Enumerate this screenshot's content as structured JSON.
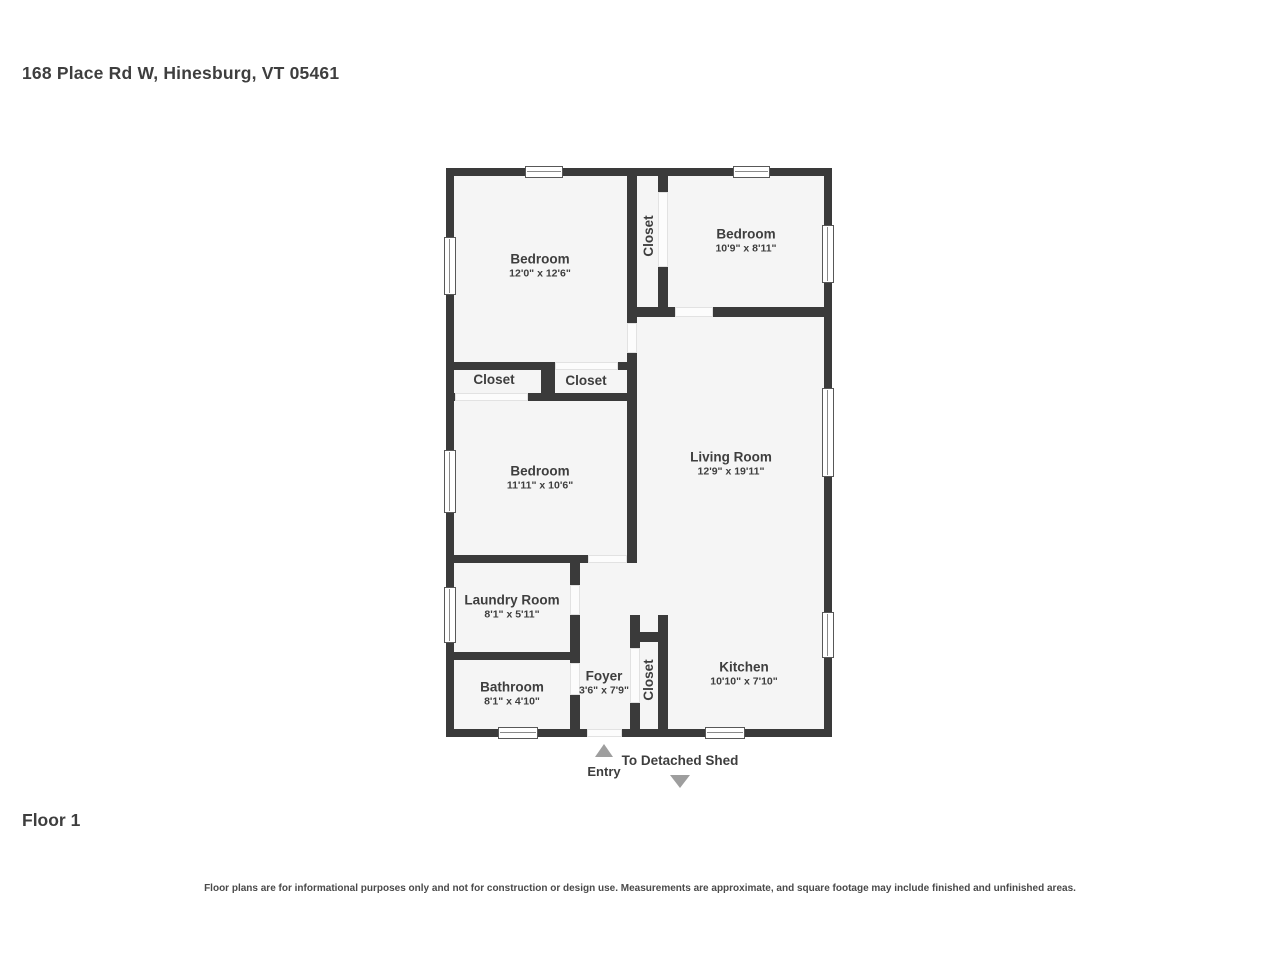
{
  "header": {
    "address": "168 Place Rd W, Hinesburg, VT 05461"
  },
  "floor": {
    "label": "Floor 1"
  },
  "annotations": {
    "entry_label": "Entry",
    "shed_label": "To Detached Shed",
    "entry_arrow_icon": "triangle-up",
    "shed_arrow_icon": "triangle-down"
  },
  "disclaimer": "Floor plans are for informational purposes only and not for construction or design use. Measurements are approximate, and square footage may include finished and unfinished areas.",
  "colors": {
    "wall": "#3a3a3a",
    "floor_fill": "#f5f5f5",
    "text": "#3e3e3e",
    "arrow": "#9e9e9e",
    "window_border": "#585858",
    "opening_line": "#e2e2e2",
    "background": "#ffffff"
  },
  "rooms": [
    {
      "name": "Bedroom",
      "dims": "12'0\" x 12'6\"",
      "cx": 540,
      "cy": 266,
      "vertical": false
    },
    {
      "name": "Closet",
      "dims": "",
      "cx": 649,
      "cy": 236,
      "vertical": true
    },
    {
      "name": "Bedroom",
      "dims": "10'9\" x 8'11\"",
      "cx": 746,
      "cy": 241,
      "vertical": false
    },
    {
      "name": "Living Room",
      "dims": "12'9\" x 19'11\"",
      "cx": 731,
      "cy": 464,
      "vertical": false
    },
    {
      "name": "Closet",
      "dims": "",
      "cx": 494,
      "cy": 380,
      "vertical": false
    },
    {
      "name": "Closet",
      "dims": "",
      "cx": 586,
      "cy": 381,
      "vertical": false
    },
    {
      "name": "Bedroom",
      "dims": "11'11\" x 10'6\"",
      "cx": 540,
      "cy": 478,
      "vertical": false
    },
    {
      "name": "Laundry Room",
      "dims": "8'1\" x 5'11\"",
      "cx": 512,
      "cy": 607,
      "vertical": false
    },
    {
      "name": "Bathroom",
      "dims": "8'1\" x 4'10\"",
      "cx": 512,
      "cy": 694,
      "vertical": false
    },
    {
      "name": "Foyer",
      "dims": "3'6\" x 7'9\"",
      "cx": 604,
      "cy": 683,
      "vertical": false
    },
    {
      "name": "Closet",
      "dims": "",
      "cx": 649,
      "cy": 680,
      "vertical": true
    },
    {
      "name": "Kitchen",
      "dims": "10'10\" x 7'10\"",
      "cx": 744,
      "cy": 674,
      "vertical": false
    }
  ],
  "plan_geometry": {
    "floor": {
      "x": 446,
      "y": 168,
      "w": 386,
      "h": 569
    },
    "walls": [
      {
        "x": 446,
        "y": 168,
        "w": 386,
        "h": 8
      },
      {
        "x": 446,
        "y": 729,
        "w": 386,
        "h": 8
      },
      {
        "x": 446,
        "y": 168,
        "w": 8,
        "h": 569
      },
      {
        "x": 824,
        "y": 168,
        "w": 8,
        "h": 569
      },
      {
        "x": 627,
        "y": 168,
        "w": 10,
        "h": 395
      },
      {
        "x": 658,
        "y": 168,
        "w": 10,
        "h": 149
      },
      {
        "x": 627,
        "y": 307,
        "w": 205,
        "h": 10
      },
      {
        "x": 446,
        "y": 362,
        "w": 191,
        "h": 8
      },
      {
        "x": 541,
        "y": 362,
        "w": 14,
        "h": 39
      },
      {
        "x": 446,
        "y": 393,
        "w": 191,
        "h": 8
      },
      {
        "x": 446,
        "y": 555,
        "w": 191,
        "h": 8
      },
      {
        "x": 570,
        "y": 555,
        "w": 10,
        "h": 182
      },
      {
        "x": 446,
        "y": 652,
        "w": 134,
        "h": 8
      },
      {
        "x": 630,
        "y": 615,
        "w": 10,
        "h": 122
      },
      {
        "x": 658,
        "y": 615,
        "w": 10,
        "h": 122
      },
      {
        "x": 630,
        "y": 632,
        "w": 38,
        "h": 10
      }
    ],
    "openings": [
      {
        "x": 555,
        "y": 362,
        "w": 63,
        "h": 8
      },
      {
        "x": 455,
        "y": 393,
        "w": 73,
        "h": 8
      },
      {
        "x": 675,
        "y": 307,
        "w": 38,
        "h": 10
      },
      {
        "x": 658,
        "y": 192,
        "w": 10,
        "h": 75
      },
      {
        "x": 627,
        "y": 323,
        "w": 10,
        "h": 30
      },
      {
        "x": 588,
        "y": 555,
        "w": 39,
        "h": 8
      },
      {
        "x": 570,
        "y": 585,
        "w": 10,
        "h": 30
      },
      {
        "x": 570,
        "y": 663,
        "w": 10,
        "h": 32
      },
      {
        "x": 630,
        "y": 648,
        "w": 10,
        "h": 55
      },
      {
        "x": 587,
        "y": 729,
        "w": 35,
        "h": 8
      }
    ],
    "windows": [
      {
        "x": 525,
        "y": 166,
        "w": 38,
        "h": 12,
        "axis": "h"
      },
      {
        "x": 733,
        "y": 166,
        "w": 37,
        "h": 12,
        "axis": "h"
      },
      {
        "x": 444,
        "y": 237,
        "w": 12,
        "h": 58,
        "axis": "v"
      },
      {
        "x": 444,
        "y": 450,
        "w": 12,
        "h": 63,
        "axis": "v"
      },
      {
        "x": 444,
        "y": 587,
        "w": 12,
        "h": 56,
        "axis": "v"
      },
      {
        "x": 822,
        "y": 225,
        "w": 12,
        "h": 58,
        "axis": "v"
      },
      {
        "x": 822,
        "y": 388,
        "w": 12,
        "h": 89,
        "axis": "v"
      },
      {
        "x": 822,
        "y": 612,
        "w": 12,
        "h": 46,
        "axis": "v"
      },
      {
        "x": 498,
        "y": 727,
        "w": 40,
        "h": 12,
        "axis": "h"
      },
      {
        "x": 705,
        "y": 727,
        "w": 40,
        "h": 12,
        "axis": "h"
      }
    ]
  }
}
